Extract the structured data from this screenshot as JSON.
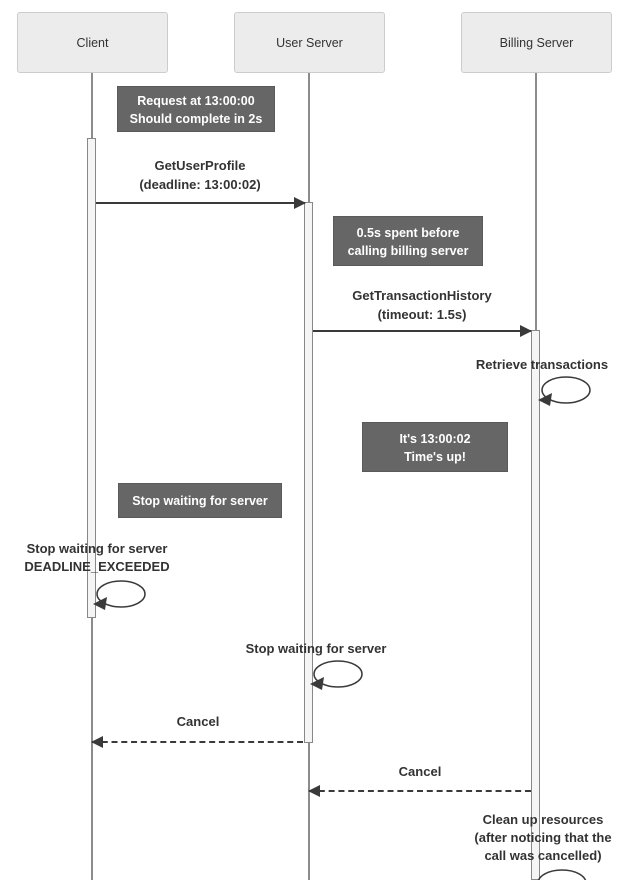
{
  "colors": {
    "note_bg": "#666666",
    "note_text": "#ffffff",
    "actor_bg": "#ececec",
    "actor_border": "#cccccc",
    "lifeline": "#8c8c8c",
    "arrow": "#3a3a3a",
    "text": "#333333",
    "activation_bg": "#f5f5f5",
    "activation_border": "#888888"
  },
  "actors": [
    {
      "label": "Client"
    },
    {
      "label": "User Server"
    },
    {
      "label": "Billing Server"
    }
  ],
  "notes": [
    {
      "text": "Request at 13:00:00\nShould complete in 2s"
    },
    {
      "text": "0.5s spent before\ncalling billing server"
    },
    {
      "text": "It's 13:00:02\nTime's up!"
    },
    {
      "text": "Stop waiting for server"
    }
  ],
  "messages": [
    {
      "label": "GetUserProfile\n(deadline: 13:00:02)",
      "style": "solid",
      "direction": "right",
      "from": "Client",
      "to": "User Server"
    },
    {
      "label": "GetTransactionHistory\n(timeout: 1.5s)",
      "style": "solid",
      "direction": "right",
      "from": "User Server",
      "to": "Billing Server"
    },
    {
      "label": "Cancel",
      "style": "dashed",
      "direction": "left",
      "from": "User Server",
      "to": "Client"
    },
    {
      "label": "Cancel",
      "style": "dashed",
      "direction": "left",
      "from": "Billing Server",
      "to": "User Server"
    }
  ],
  "self_messages": [
    {
      "label": "Retrieve transactions",
      "actor": "Billing Server"
    },
    {
      "label": "Stop waiting for server\nDEADLINE_EXCEEDED",
      "actor": "Client"
    },
    {
      "label": "Stop waiting for server",
      "actor": "User Server"
    },
    {
      "label": "Clean up resources\n(after noticing that the\ncall was cancelled)",
      "actor": "Billing Server"
    }
  ]
}
